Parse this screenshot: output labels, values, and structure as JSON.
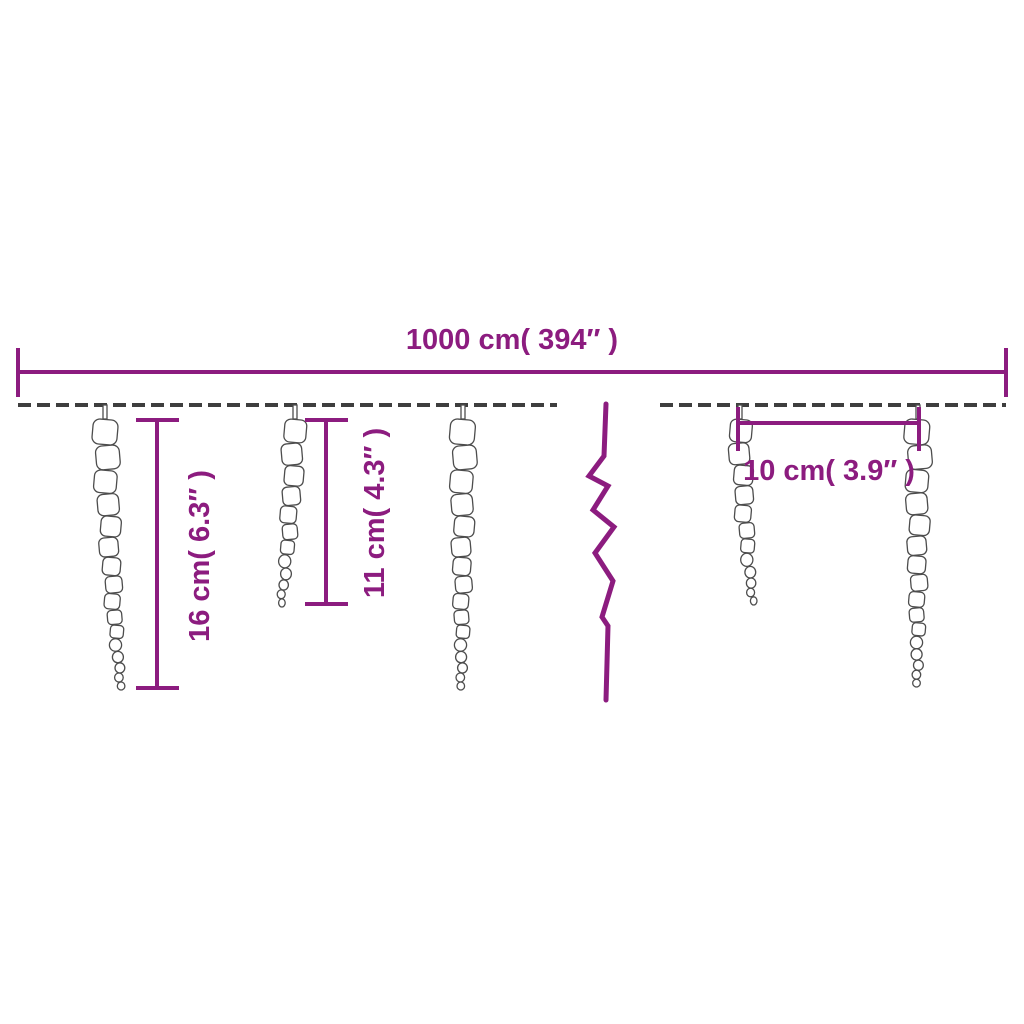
{
  "diagram": {
    "type": "product-dimension-diagram",
    "subject": "icicle string lights",
    "dimensions": {
      "total_width": {
        "label": "1000 cm( 394″ )"
      },
      "icicle_height_large": {
        "label": "16 cm( 6.3″ )"
      },
      "icicle_height_medium": {
        "label": "11 cm( 4.3″ )"
      },
      "icicle_spacing": {
        "label": "10 cm( 3.9″ )"
      }
    },
    "colors": {
      "dimension": "#8C1C7F",
      "cable": "#3E3E3E",
      "icicle_stroke": "#4D4D4D",
      "background": "#FFFFFF"
    },
    "cable": {
      "y": 405,
      "segments": [
        {
          "x1": 18,
          "x2": 557
        },
        {
          "x1": 660,
          "x2": 1006
        }
      ]
    },
    "icicles": [
      {
        "x": 105,
        "length": 285,
        "beads": 16,
        "max_radius": 12.5,
        "drift": 16
      },
      {
        "x": 295,
        "length": 202,
        "beads": 12,
        "max_radius": 11,
        "drift": -14
      },
      {
        "x": 463,
        "length": 285,
        "beads": 16,
        "max_radius": 12.5,
        "drift": -2
      },
      {
        "x": 740,
        "length": 200,
        "beads": 12,
        "max_radius": 11,
        "drift": 13
      },
      {
        "x": 918,
        "length": 282,
        "beads": 16,
        "max_radius": 12.5,
        "drift": -1
      }
    ]
  }
}
